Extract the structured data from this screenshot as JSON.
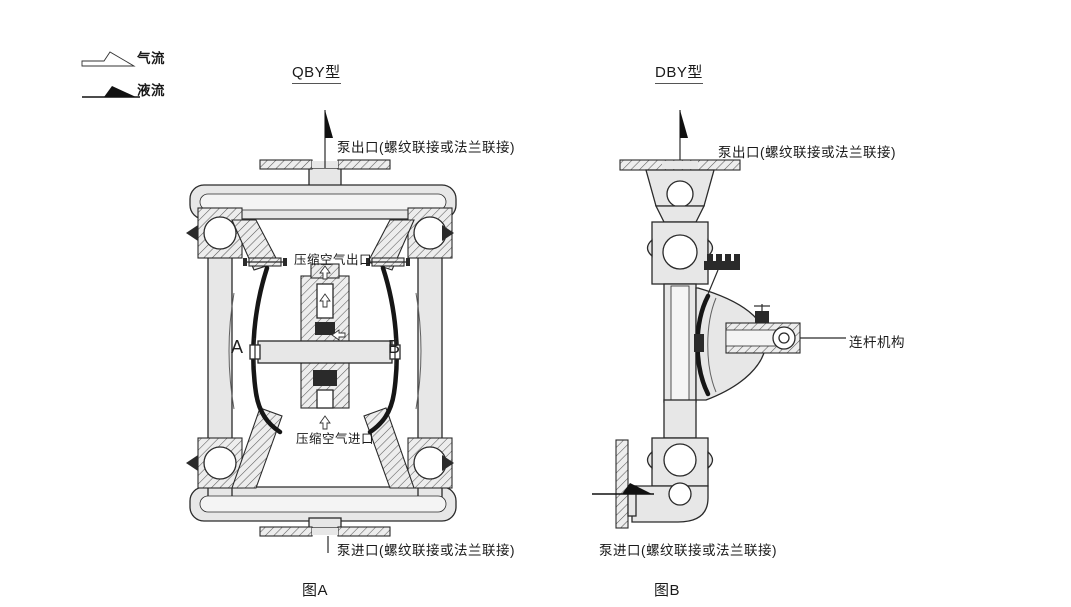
{
  "colors": {
    "line": "#2a2a2a",
    "metal": "#e7e7e7",
    "paper": "#ffffff"
  },
  "legend": {
    "air": "气流",
    "liquid": "液流"
  },
  "figure_a": {
    "title": "QBY型",
    "outlet_label": "泵出口(螺纹联接或法兰联接)",
    "air_outlet_label": "压缩空气出口",
    "air_inlet_label": "压缩空气进口",
    "inlet_label": "泵进口(螺纹联接或法兰联接)",
    "chamber_a": "A",
    "chamber_b": "B",
    "caption": "图A"
  },
  "figure_b": {
    "title": "DBY型",
    "outlet_label": "泵出口(螺纹联接或法兰联接)",
    "linkage_label": "连杆机构",
    "inlet_label": "泵进口(螺纹联接或法兰联接)",
    "caption": "图B"
  }
}
